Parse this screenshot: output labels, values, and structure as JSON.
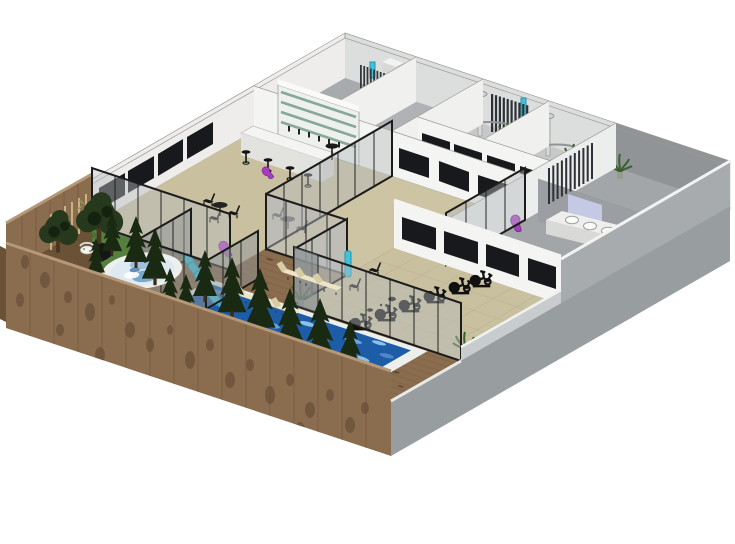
{
  "meta": {
    "title": "3D cutaway floor plan - wellness spa and fitness club",
    "style": "SketchUp-style isometric architectural render, white background",
    "camera": "aerial view from the south-west"
  },
  "palette": {
    "bg": "#ffffff",
    "wallWhite": "#f4f4f2",
    "wallLight": "#e9e9e7",
    "wallShade": "#dcdedd",
    "wallGray": "#a7abae",
    "wallGrayDark": "#909497",
    "floorGray": "#a8abad",
    "floorGrayLight": "#c7c9c9",
    "floorTan": "#c9c09f",
    "floorTanLight": "#cdc4a3",
    "glass": "#b7bcbe",
    "frame": "#1c1c1c",
    "windowDark": "#17191c",
    "wood": "#8a6c4e",
    "woodDark": "#6b5136",
    "woodStreak": "#53402c",
    "woodCap": "#b49877",
    "grass": "#557f3d",
    "grassDark": "#47702f",
    "rug": "#161616",
    "stone": "#e8e9e3",
    "poolBlue": "#1d5ca6",
    "poolLight": "#5e9ad8",
    "rim": "#edefec",
    "tubWater": "#dfe9f2",
    "cyan": "#3fc3dc",
    "magenta": "#aa3cc0",
    "cream": "#ece4c4",
    "creamDark": "#d6cca6",
    "black": "#141414",
    "treeDark": "#26391d",
    "treeDarker": "#14230f",
    "pine": "#1a2a12",
    "plant": "#3c6130",
    "shelfGreen": "#86a898",
    "mirror": "#c9cde9",
    "skirt": "#a7abae",
    "skirtDark": "#989da0",
    "radiator": "#33383c"
  },
  "scene": {
    "rooms": [
      {
        "id": "utility-room",
        "name": "Utility room",
        "floor": "gray",
        "items": [
          "slatted wall radiator with teal accent",
          "wall duct box"
        ]
      },
      {
        "id": "storage-room",
        "name": "Storage room",
        "floor": "gray",
        "items": []
      },
      {
        "id": "shower-room-1",
        "name": "Shower room 1",
        "floor": "light gray",
        "items": [
          "curved glass shower screen",
          "rain shower column",
          "potted plant",
          "tall towel radiator"
        ]
      },
      {
        "id": "shower-room-2",
        "name": "Shower room 2",
        "floor": "light gray",
        "items": [
          "curved glass shower screen",
          "rain shower column",
          "potted plant"
        ]
      },
      {
        "id": "changing-room",
        "name": "Changing room / washroom",
        "floor": "gray",
        "items": [
          "vanity with 3 round sinks",
          "lavender mirror",
          "slatted towel radiator",
          "white steps",
          "black screen",
          "potted plants"
        ]
      },
      {
        "id": "bar-lounge",
        "name": "Juice bar and lounge",
        "floor": "tan",
        "items": [
          "back-bar shelving with green glass shelves and bottles",
          "white bar counter",
          "bar stools",
          "bistro tables with black chairs",
          "magenta lounge chairs",
          "dark window band on wall"
        ]
      },
      {
        "id": "central-studio",
        "name": "Central studio (empty, glass walled)",
        "floor": "tan",
        "items": [
          "magenta lounge chair"
        ]
      },
      {
        "id": "relaxation-room",
        "name": "Glass relaxation room",
        "floor": "wood deck",
        "items": [
          "aqua relaxation loungers"
        ]
      },
      {
        "id": "spin-studio",
        "name": "Gym / spin studio",
        "floor": "tan tile",
        "items": [
          "row of spin bikes",
          "black chairs",
          "potted plants",
          "teal water cooler",
          "ink-blot floor marks"
        ]
      }
    ],
    "outdoor": {
      "deck": "wood plank deck with knots",
      "garden": [
        "grass patch",
        "black round rug with white lounge chair",
        "stepping stones",
        "bamboo screen",
        "two dark leafy trees"
      ],
      "water": [
        "round hot tub with white rim",
        "rectangular swimming pool with white rim"
      ],
      "furniture": [
        "cream sun loungers in two groups of three"
      ],
      "perimeter": [
        "tall mottled wood fence on west and south",
        "gray concrete skirt on east"
      ],
      "trees": "dark pine silhouettes along pool and hot tub"
    },
    "counts": {
      "spin_bikes": 6,
      "aqua_loungers": 5,
      "sun_loungers": 6,
      "bar_stools": 4,
      "magenta_chairs": 3,
      "showers": 2,
      "sinks": 3,
      "garden_trees": 2,
      "pine_trees": 11
    }
  }
}
